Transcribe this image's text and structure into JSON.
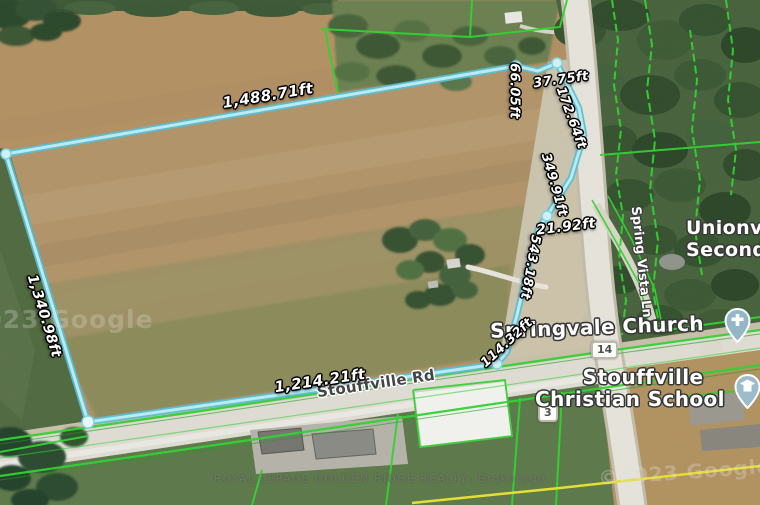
{
  "map_overlay": {
    "boundary_color": "#8adbe8",
    "parcel_line_color": "#2fd32f",
    "measurements": {
      "top_edge": "1,488.71ft",
      "left_edge": "1,340.98ft",
      "bottom_edge": "1,214.21ft",
      "seg_66": "66.05ft",
      "seg_37": "37.75ft",
      "seg_172": "172.64ft",
      "seg_349": "349.91ft",
      "seg_21": "21.92ft",
      "seg_543": "543.18ft",
      "seg_114": "114.32ft"
    }
  },
  "roads": {
    "stouffville_rd": "Stouffville Rd",
    "spring_vista_ln": "Spring Vista Ln",
    "route_badge_main": "14",
    "route_badge_secondary": "3"
  },
  "places": {
    "church_label": "Springvale Church",
    "school_line1": "Stouffville",
    "school_line2": "Christian School",
    "secondary_line1": "Unionville",
    "secondary_line2": "Secondary"
  },
  "watermarks": {
    "brokerage": "ROYAL LEPAGE GOLDEN RIDGE REALTY, Brokerage",
    "google_left": "©2023 Google",
    "google_right": "©2023 Google"
  }
}
